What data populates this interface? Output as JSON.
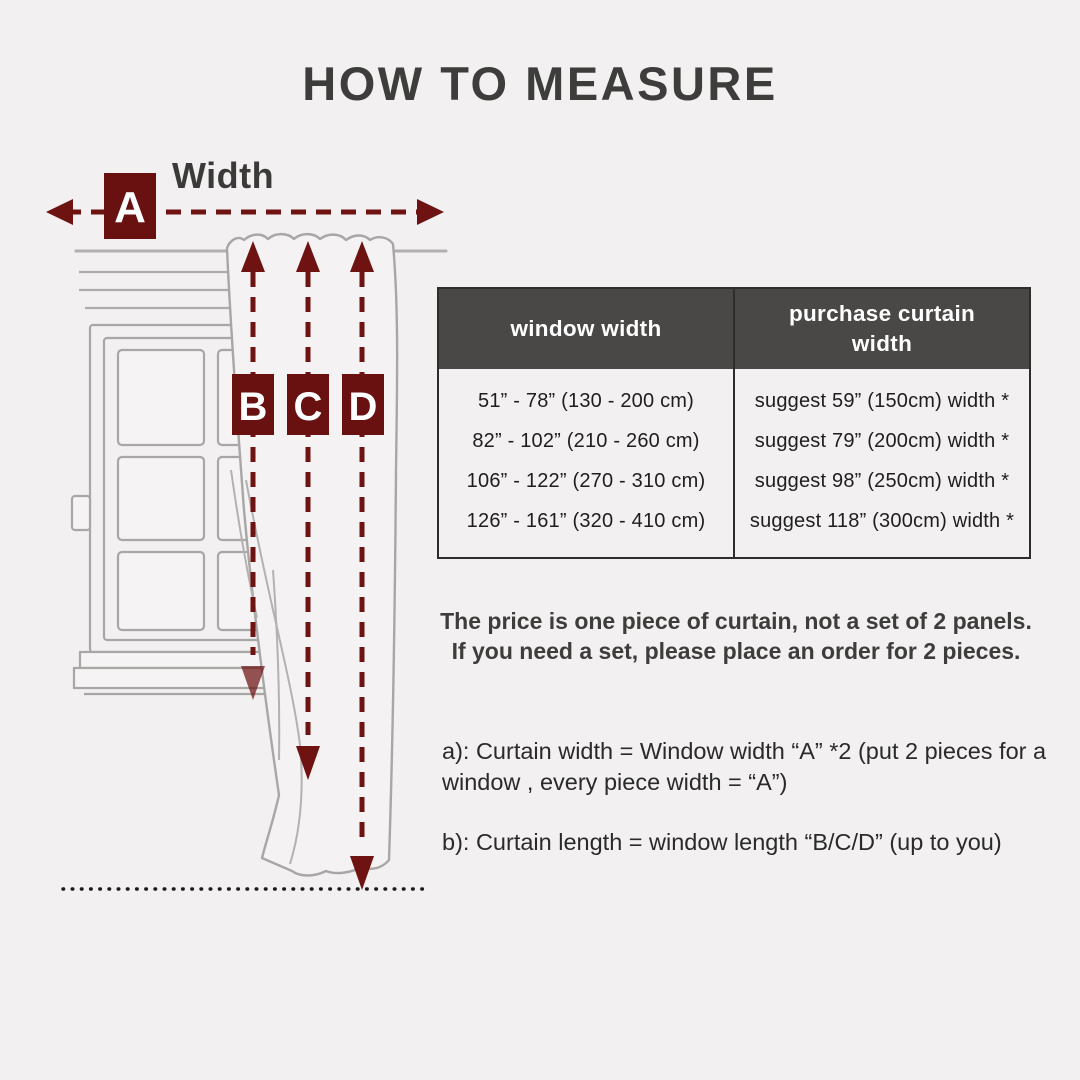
{
  "title": "HOW TO MEASURE",
  "diagram": {
    "width_label": "Width",
    "marker_a": "A",
    "marker_b": "B",
    "marker_c": "C",
    "marker_d": "D"
  },
  "table": {
    "headers": [
      "window width",
      "purchase curtain width"
    ],
    "rows": [
      [
        "51” - 78” (130 - 200 cm)",
        "suggest 59” (150cm) width *"
      ],
      [
        "82” - 102” (210 - 260 cm)",
        "suggest 79” (200cm) width *"
      ],
      [
        "106” - 122” (270 - 310 cm)",
        "suggest 98” (250cm) width *"
      ],
      [
        "126” - 161” (320 - 410 cm)",
        "suggest 118” (300cm) width *"
      ]
    ]
  },
  "notes": {
    "price_note": "The price is one piece of curtain, not a set of 2 panels. If you need a set, please place an order for 2 pieces.",
    "note_a": "a): Curtain width = Window width “A” *2 (put 2 pieces for a window , every piece width = “A”)",
    "note_b": "b): Curtain length = window length “B/C/D” (up to you)"
  },
  "colors": {
    "accent_red": "#6e1212",
    "marker_red": "#691111",
    "table_header_bg": "#4a4846",
    "background": "#f2f0f0",
    "sketch_gray": "#a9a6a6",
    "floor_dots": "#1b1b1b"
  }
}
